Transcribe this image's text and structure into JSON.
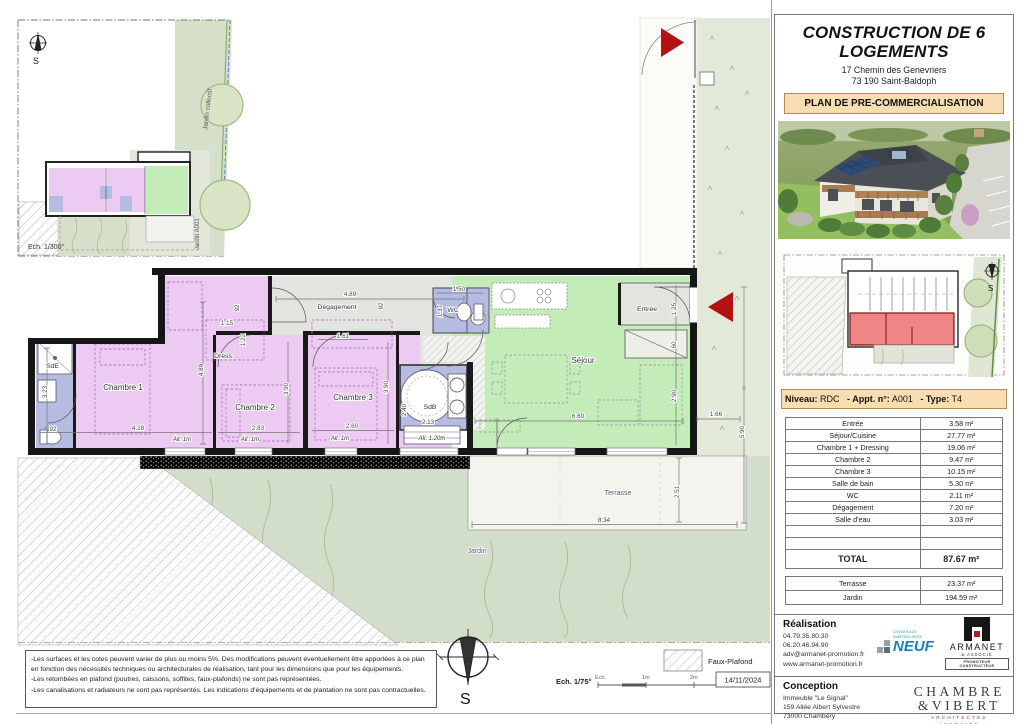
{
  "title_block": {
    "title_line1": "CONSTRUCTION DE 6",
    "title_line2": "LOGEMENTS",
    "address_line1": "17 Chemin des Genevriers",
    "address_line2": "73 190 Saint-Baldoph",
    "plan_type": "PLAN DE PRE-COMMERCIALISATION"
  },
  "apartment": {
    "niveau_label": "Niveau:",
    "niveau": "RDC",
    "appt_label": "- Appt. n°:",
    "appt": "A001",
    "type_label": "- Type:",
    "type": "T4"
  },
  "areas": {
    "rows": [
      {
        "label": "Entrée",
        "value": "3.58 m²"
      },
      {
        "label": "Séjour/Cuisine",
        "value": "27.77 m²"
      },
      {
        "label": "Chambre 1 + Dressing",
        "value": "19.06 m²"
      },
      {
        "label": "Chambre 2",
        "value": "9.47 m²"
      },
      {
        "label": "Chambre 3",
        "value": "10.15 m²"
      },
      {
        "label": "Salle de bain",
        "value": "5.30 m²"
      },
      {
        "label": "WC",
        "value": "2.11 m²"
      },
      {
        "label": "Dégagement",
        "value": "7.20 m²"
      },
      {
        "label": "Salle d'eau",
        "value": "3.03 m²"
      }
    ],
    "total_label": "TOTAL",
    "total_value": "87.67 m²",
    "extras": [
      {
        "label": "Terrasse",
        "value": "23.37 m²"
      },
      {
        "label": "Jardin",
        "value": "194.59 m²"
      }
    ]
  },
  "realisation": {
    "title": "Réalisation",
    "phone1": "04.79.35.80.30",
    "phone2": "06.20.46.94.90",
    "email": "adv@armanet-promotion.fr",
    "website": "www.armanet-promotion.fr",
    "neuf_top": "GÉNÉRALE IMMOBILIÈRE",
    "neuf_main": "NEUF",
    "armanet_name": "ARMANET",
    "armanet_amp": "&",
    "armanet_sub": "ASSOCIÉ",
    "armanet_tagline": "PROMOTEUR CONSTRUCTEUR"
  },
  "conception": {
    "title": "Conception",
    "line1": "Immeuble \"Le Signal\"",
    "line2": "159 Allée Albert Sylvestre",
    "line3": "73000 Chambéry",
    "firm_line1": "CHAMBRE",
    "firm_line2": "&VIBERT",
    "firm_sub1": "ARCHITECTES",
    "firm_sub2": "ASSOCIÉS"
  },
  "site_plan": {
    "scale": "Ech. 1/300°",
    "jardin_collectif": "Jardin collectif",
    "jardin_unit": "Jardin A001",
    "compass_s": "S"
  },
  "key_plan": {
    "compass_s": "S"
  },
  "plan": {
    "rooms": {
      "sde": "SdE",
      "chambre1": "Chambre 1",
      "dress": "Dress.",
      "chambre2": "Chambre 2",
      "chambre3": "Chambre 3",
      "degagement": "Dégagement",
      "wc": "WC",
      "sdb": "SdB",
      "sejour": "Séjour",
      "entree": "Entrée",
      "terrasse": "Terrasse",
      "jardin": "Jardin"
    },
    "dims": {
      "corridor_w": "4.89",
      "corridor_h1": "92",
      "corridor_h2": "92",
      "dress_w": "1.15",
      "dress_h": "1.22",
      "closet3_w": "1.61",
      "wc_w": "1.50",
      "wc_h": "1.37",
      "left_v": "4.89",
      "sde_h": "3.23",
      "sde_w": "92",
      "ch1_w": "4.28",
      "ch2_w": "2.83",
      "ch2_h": "3.90",
      "ch3_h": "3.90",
      "ch3_w": "2.60",
      "sdb_h": "2.40",
      "sdb_w": "2.13",
      "sejour_w": "6.60",
      "entree_h": "1.25",
      "entree_w": "60",
      "sejour_h": "2.90",
      "right_w": "1.66",
      "right_v": "5.90",
      "terrasse_h": "2.51",
      "terrasse_w": "8.34",
      "all1": "All. 1m",
      "all2": "All. 1m",
      "all3": "All. 1m",
      "all4": "All. 1.20m"
    }
  },
  "footer": {
    "notes": [
      "-Les surfaces et les cotes peuvent varier de plus ou moins 5%. Des modifications peuvent éventuellement être apportées à ce plan en fonction des nécessités techniques ou architecturales de réalisation, tant pour les dimensions que pour les équipements.",
      "-Les retombées en plafond (poutres, caissons, soffites, faux-plafonds) ne sont pas représentées.",
      "-Les canalisations et radiateurs ne sont pas représentés. Les indications d'équipements et de plantation ne sont pas contractuelles."
    ],
    "scale_label": "Ech. 1/75°",
    "ticks": [
      "Ech.",
      "1m",
      "2m",
      "3m"
    ],
    "date": "14/11/2024",
    "faux_plafond": "Faux-Plafond",
    "compass_s": "S"
  }
}
